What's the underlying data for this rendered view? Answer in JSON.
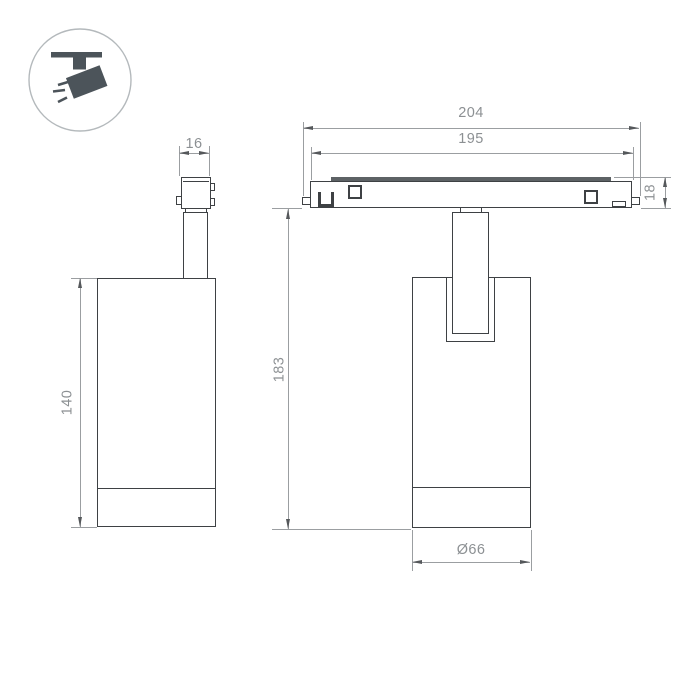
{
  "drawing": {
    "badge_icon": "track-spotlight",
    "views": {
      "side_view": {
        "dimensions": {
          "adapter_width": "16",
          "body_height": "140"
        }
      },
      "front_view": {
        "dimensions": {
          "track_length_overall": "204",
          "track_length_body": "195",
          "track_height": "18",
          "hanging_height": "183",
          "body_diameter": "Ø66"
        }
      }
    }
  },
  "colors": {
    "object_line": "#3e4144",
    "dimension_line": "#9b9ea1",
    "arrowhead": "#55585b",
    "dimension_text": "#8c9093",
    "icon_fill": "#4c545a",
    "icon_ring": "#b4b9bc",
    "rail_surface": "#5d6265",
    "background": "#ffffff"
  }
}
